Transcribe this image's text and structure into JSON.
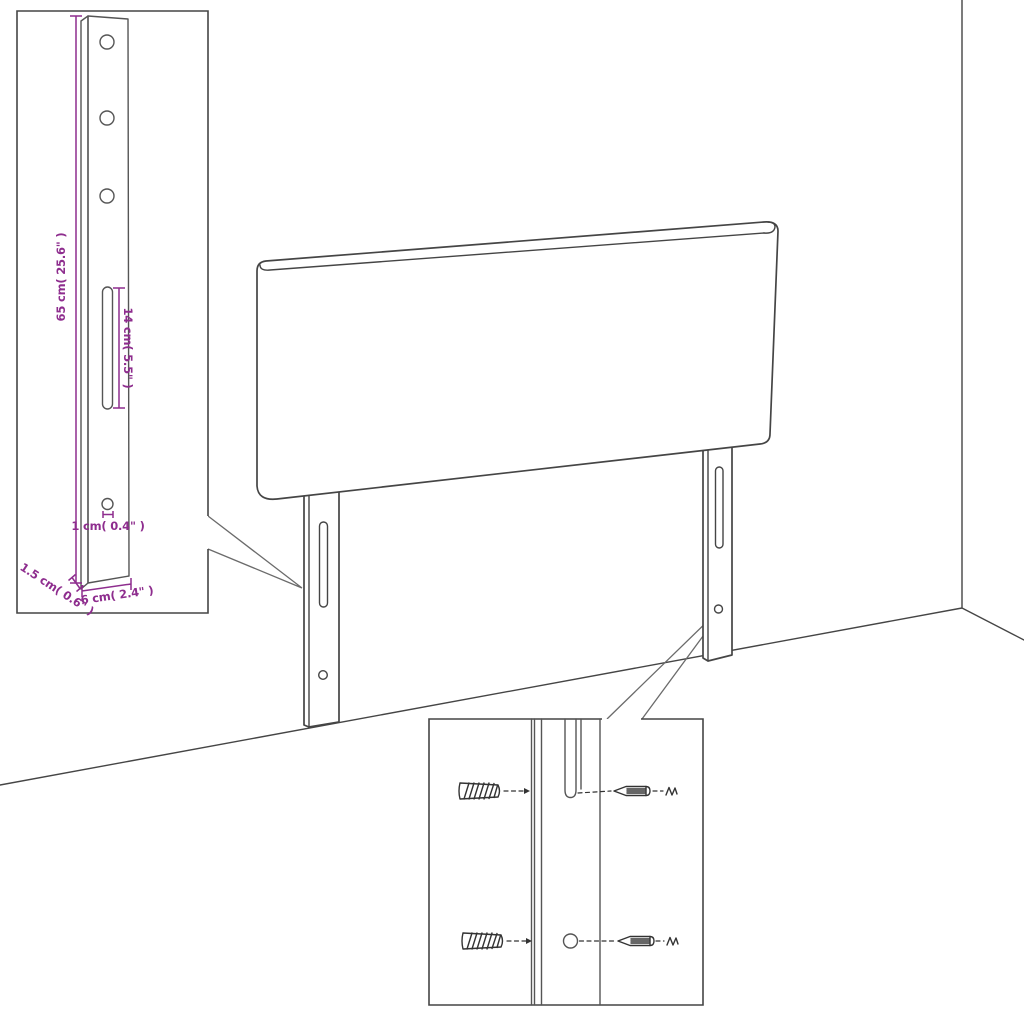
{
  "colors": {
    "accent": "#8e2d8e",
    "line": "#454545",
    "hardware": "#333333"
  },
  "subject": "headboard-with-mounting-legs",
  "leg_detail_inset": {
    "height_label": "65 cm( 25.6\" )",
    "slot_label": "14 cm( 5.5\" )",
    "hole_label": "1 cm( 0.4\" )",
    "depth_label": "1.5 cm( 0.6\" )",
    "width_label": "6 cm( 2.4\" )"
  },
  "hardware_detail_inset": {
    "icons": [
      "wall-plug-icon",
      "screw-icon"
    ]
  }
}
